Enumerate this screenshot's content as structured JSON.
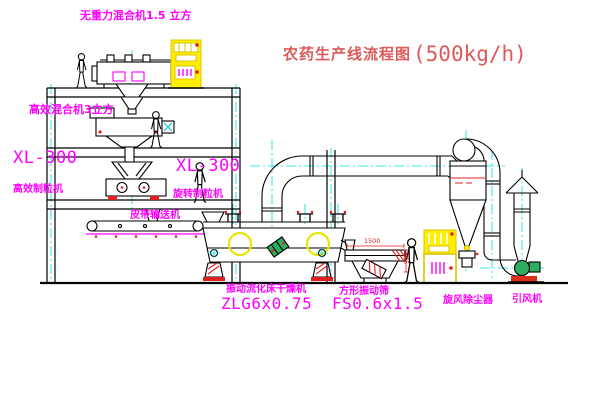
{
  "title": {
    "text": "农药生产线流程图",
    "capacity": "(500kg/h)"
  },
  "equipment_labels": {
    "gravity_mixer": "无重力混合机1.5 立方",
    "high_eff_mixer": "高效混合机3立方",
    "granulator_left_model": "XL-300",
    "granulator_left_name": "高效制粒机",
    "granulator_mid_model": "XL-300",
    "granulator_mid_name": "旋转制粒机",
    "belt_conveyor": "皮带输送机",
    "dryer_name": "振动流化床干燥机",
    "dryer_model": "ZLG6x0.75",
    "sieve_name": "方形振动筛",
    "sieve_model": "FS0.6x1.5",
    "cyclone": "旋风除尘器",
    "fan": "引风机"
  },
  "dimensions": {
    "sieve_length": "1500",
    "sieve_height": "345"
  },
  "colors": {
    "label_magenta": "#ff00ff",
    "title_red": "#dc5a5a",
    "centerline_cyan": "#00e0e0",
    "line_black": "#000000",
    "cabinet_yellow": "#ffee00",
    "accent_red": "#e02020",
    "motor_green": "#2fae60",
    "crosshair_yellow": "#e6e600"
  }
}
